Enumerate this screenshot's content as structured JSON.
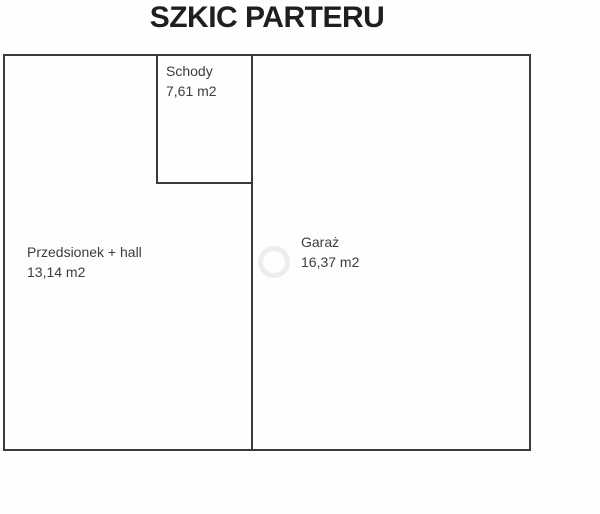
{
  "title": "SZKIC PARTERU",
  "floorplan": {
    "rooms": [
      {
        "name": "Schody",
        "area": "7,61 m2"
      },
      {
        "name": "Przedsionek + hall",
        "area": "13,14 m2"
      },
      {
        "name": "Garaż",
        "area": "16,37 m2"
      }
    ],
    "watermark_icon": "ring-watermark"
  },
  "colors": {
    "wall": "#3a3a3a",
    "title_text": "#1f1f1f",
    "label_text": "#3d3d3d",
    "background": "#fefefe",
    "watermark": "#ededed"
  }
}
